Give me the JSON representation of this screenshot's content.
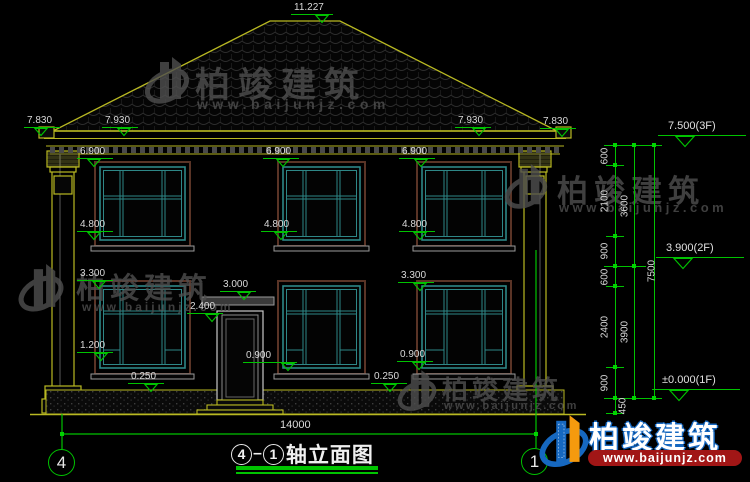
{
  "watermark": {
    "brand": "柏竣建筑",
    "url": "www.baijunjz.com"
  },
  "footer_logo": {
    "brand": "柏竣建筑",
    "url": "www.baijunjz.com"
  },
  "title_block": {
    "axis_left": "4",
    "axis_right": "1",
    "name": "轴立面图"
  },
  "axes": {
    "left": "4",
    "right": "1"
  },
  "overall_dim": "14000",
  "elevation_markers": [
    {
      "label": "11.227",
      "tx": 294,
      "ty": 3,
      "ax": 322
    },
    {
      "label": "7.830",
      "tx": 27,
      "ty": 116,
      "ax": 41
    },
    {
      "label": "7.930",
      "tx": 105,
      "ty": 116,
      "ax": 124
    },
    {
      "label": "7.930",
      "tx": 458,
      "ty": 116,
      "ax": 479
    },
    {
      "label": "7.830",
      "tx": 543,
      "ty": 117,
      "ax": 562
    },
    {
      "label": "6.900",
      "tx": 80,
      "ty": 147,
      "ax": 94
    },
    {
      "label": "6.900",
      "tx": 266,
      "ty": 147,
      "ax": 283
    },
    {
      "label": "6.900",
      "tx": 402,
      "ty": 147,
      "ax": 421
    },
    {
      "label": "4.800",
      "tx": 80,
      "ty": 220,
      "ax": 94
    },
    {
      "label": "4.800",
      "tx": 264,
      "ty": 220,
      "ax": 281
    },
    {
      "label": "4.800",
      "tx": 402,
      "ty": 220,
      "ax": 420
    },
    {
      "label": "3.300",
      "tx": 80,
      "ty": 269,
      "ax": 99
    },
    {
      "label": "3.300",
      "tx": 401,
      "ty": 271,
      "ax": 420
    },
    {
      "label": "3.000",
      "tx": 223,
      "ty": 280,
      "ax": 244
    },
    {
      "label": "2.400",
      "tx": 190,
      "ty": 302,
      "ax": 212
    },
    {
      "label": "1.200",
      "tx": 80,
      "ty": 341,
      "ax": 101
    },
    {
      "label": "0.900",
      "tx": 246,
      "ty": 351,
      "ax": 288
    },
    {
      "label": "0.900",
      "tx": 400,
      "ty": 350,
      "ax": 419
    },
    {
      "label": "0.250",
      "tx": 131,
      "ty": 372,
      "ax": 151
    },
    {
      "label": "0.250",
      "tx": 374,
      "ty": 372,
      "ax": 390
    }
  ],
  "right_levels": [
    {
      "label": "7.500(3F)",
      "tx": 668,
      "ty": 121
    },
    {
      "label": "3.900(2F)",
      "tx": 666,
      "ty": 243
    },
    {
      "label": "±0.000(1F)",
      "tx": 662,
      "ty": 375
    }
  ],
  "right_chain": {
    "lines": [
      {
        "x": 615,
        "y1": 145,
        "y2": 413
      },
      {
        "x": 634,
        "y1": 145,
        "y2": 398
      },
      {
        "x": 654,
        "y1": 145,
        "y2": 398
      }
    ],
    "labels": [
      {
        "text": "600",
        "x": 605,
        "y": 156
      },
      {
        "text": "2100",
        "x": 605,
        "y": 201
      },
      {
        "text": "900",
        "x": 605,
        "y": 251
      },
      {
        "text": "600",
        "x": 605,
        "y": 277
      },
      {
        "text": "2400",
        "x": 605,
        "y": 327
      },
      {
        "text": "900",
        "x": 605,
        "y": 383
      },
      {
        "text": "450",
        "x": 623,
        "y": 406
      },
      {
        "text": "3600",
        "x": 625,
        "y": 206
      },
      {
        "text": "3900",
        "x": 625,
        "y": 332
      },
      {
        "text": "7500",
        "x": 652,
        "y": 271
      }
    ],
    "ticks": [
      [
        615,
        145
      ],
      [
        615,
        165
      ],
      [
        615,
        236
      ],
      [
        615,
        266
      ],
      [
        615,
        286
      ],
      [
        615,
        367
      ],
      [
        615,
        398
      ],
      [
        615,
        413
      ],
      [
        634,
        145
      ],
      [
        634,
        266
      ],
      [
        634,
        398
      ],
      [
        654,
        145
      ],
      [
        654,
        398
      ]
    ],
    "bars": [
      {
        "x1": 604,
        "x2": 662,
        "y": 145
      },
      {
        "x1": 604,
        "x2": 646,
        "y": 266
      },
      {
        "x1": 604,
        "x2": 662,
        "y": 398
      },
      {
        "x1": 606,
        "x2": 624,
        "y": 165
      },
      {
        "x1": 606,
        "x2": 624,
        "y": 236
      },
      {
        "x1": 606,
        "x2": 624,
        "y": 286
      },
      {
        "x1": 606,
        "x2": 624,
        "y": 367
      },
      {
        "x1": 606,
        "x2": 624,
        "y": 413
      }
    ]
  },
  "geometry": {
    "window_columns": [
      {
        "x": 100,
        "w": 85,
        "m": [
          120,
          162
        ]
      },
      {
        "x": 283,
        "w": 77,
        "m": [
          303,
          337
        ]
      },
      {
        "x": 422,
        "w": 84,
        "m": [
          444,
          482
        ]
      }
    ],
    "floor2": {
      "y": 167,
      "h": 73,
      "rail": 196
    },
    "floor1": {
      "y": 286,
      "h": 82,
      "rail_top": 311,
      "rail_bottom": 350
    }
  },
  "colors": {
    "line_yellow": "#b9b922",
    "dim_green": "#00c300",
    "window_teal": "#2e8787",
    "trim_brown": "#5a3426",
    "text_white": "#dcdcdc",
    "watermark_gray": "#4f4f4f",
    "logo_blue": "#1668c0",
    "logo_orange": "#f59a0e",
    "banner_red": "#a11616"
  }
}
